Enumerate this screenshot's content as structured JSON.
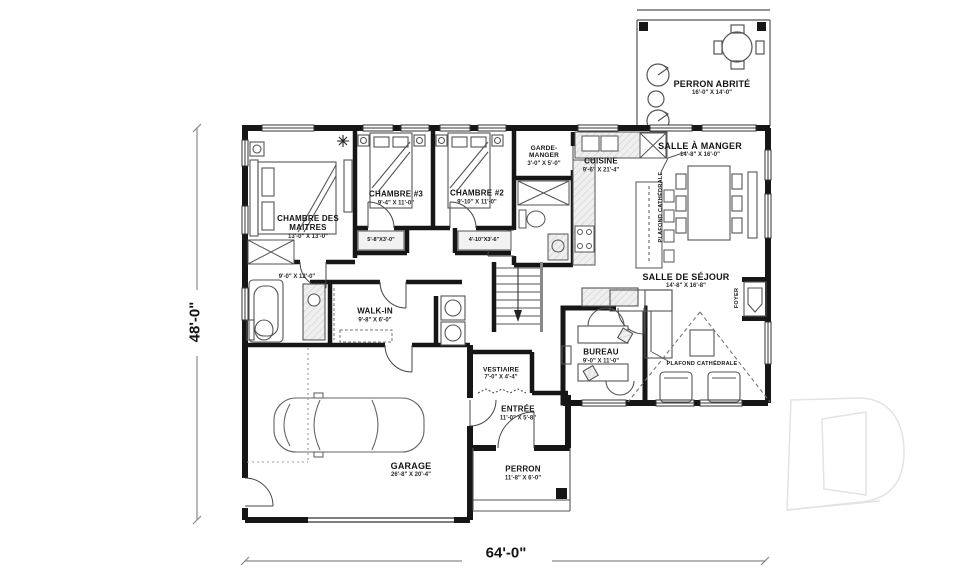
{
  "dimensions": {
    "overall_width": "64'-0\"",
    "overall_height": "48'-0\""
  },
  "rooms": {
    "perron_abrite": {
      "name": "PERRON ABRITÉ",
      "size": "16'-0\" X 14'-0\""
    },
    "chambre_des_maitres": {
      "name": "CHAMBRE DES MAITRES",
      "size": "13'-0\" X 13'-0\""
    },
    "chambre_3": {
      "name": "CHAMBRE #3",
      "size": "9'-4\" X 11'-0\""
    },
    "chambre_2": {
      "name": "CHAMBRE #2",
      "size": "9'-10\" X 11'-0\""
    },
    "garde_manger": {
      "name": "GARDE-MANGER",
      "size": "3'-0\" X 5'-0\""
    },
    "cuisine": {
      "name": "CUISINE",
      "size": "9'-6\" X 21'-4\""
    },
    "salle_a_manger": {
      "name": "SALLE À MANGER",
      "size": "14'-8\" X 16'-0\""
    },
    "salle_de_sejour": {
      "name": "SALLE DE SÉJOUR",
      "size": "14'-8\" X 16'-8\""
    },
    "salle_de_bain": {
      "size": "9'-0\" X 12'-0\""
    },
    "walk_in": {
      "name": "WALK-IN",
      "size": "9'-8\" X 6'-0\""
    },
    "vestiaire": {
      "name": "VESTIAIRE",
      "size": "7'-0\" X 4'-4\""
    },
    "bureau": {
      "name": "BUREAU",
      "size": "9'-0\" X 11'-0\""
    },
    "entree": {
      "name": "ENTRÉE",
      "size": "11'-0\" X 5'-8\""
    },
    "garage": {
      "name": "GARAGE",
      "size": "26'-8\" X 20'-4\""
    },
    "perron": {
      "name": "PERRON",
      "size": "11'-8\" X 6'-0\""
    }
  },
  "closets": {
    "closet_chambre_3": "5'-8\"X3'-0\"",
    "closet_chambre_2": "4'-10\"X3'-6\""
  },
  "annotations": {
    "plafond_cathedrale_dining": "PLAFOND CATHÉDRALE",
    "plafond_cathedrale_sejour": "PLAFOND CATHÉDRALE",
    "foyer": "FOYER"
  },
  "icons": {
    "watermark": "letter-d-outline-logo",
    "ceiling_fan": "ceiling-fan-icon",
    "stairs_arrow": "stairs-down-arrow"
  },
  "colors": {
    "wall": "#161616",
    "furniture_line": "#555555",
    "light_fill": "#ececec",
    "watermark_line": "#e3e3e3"
  }
}
